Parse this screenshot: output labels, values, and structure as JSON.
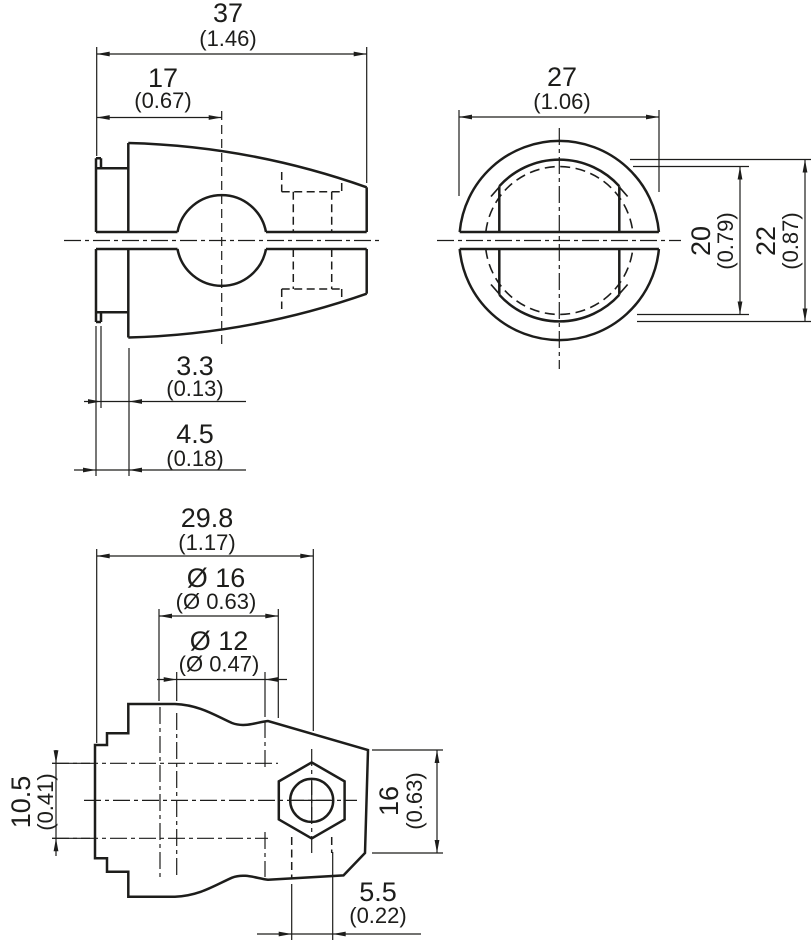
{
  "title": "Clamp bracket dimensional drawing",
  "colors": {
    "line": "#1d1d1b",
    "background": "#ffffff"
  },
  "views": {
    "side": {
      "dims": {
        "total_length": {
          "mm": "37",
          "inch": "(1.46)"
        },
        "bore_center": {
          "mm": "17",
          "inch": "(0.67)"
        },
        "groove_width": {
          "mm": "3.3",
          "inch": "(0.13)"
        },
        "flange_depth": {
          "mm": "4.5",
          "inch": "(0.18)"
        }
      }
    },
    "front": {
      "dims": {
        "outer_diameter": {
          "mm": "27",
          "inch": "(1.06)"
        },
        "bore_diameter": {
          "mm": "20",
          "inch": "(0.79)"
        },
        "seat_diameter": {
          "mm": "22",
          "inch": "(0.87)"
        }
      }
    },
    "bottom": {
      "dims": {
        "length_to_screw_axis": {
          "mm": "29.8",
          "inch": "(1.17)"
        },
        "counterbore_diameter": {
          "mm": "Ø 16",
          "inch": "(Ø 0.63)"
        },
        "bore_diameter": {
          "mm": "Ø 12",
          "inch": "(Ø 0.47)"
        },
        "flange_height": {
          "mm": "10.5",
          "inch": "(0.41)"
        },
        "head_height": {
          "mm": "16",
          "inch": "(0.63)"
        },
        "screw_hole": {
          "mm": "5.5",
          "inch": "(0.22)"
        }
      }
    }
  }
}
